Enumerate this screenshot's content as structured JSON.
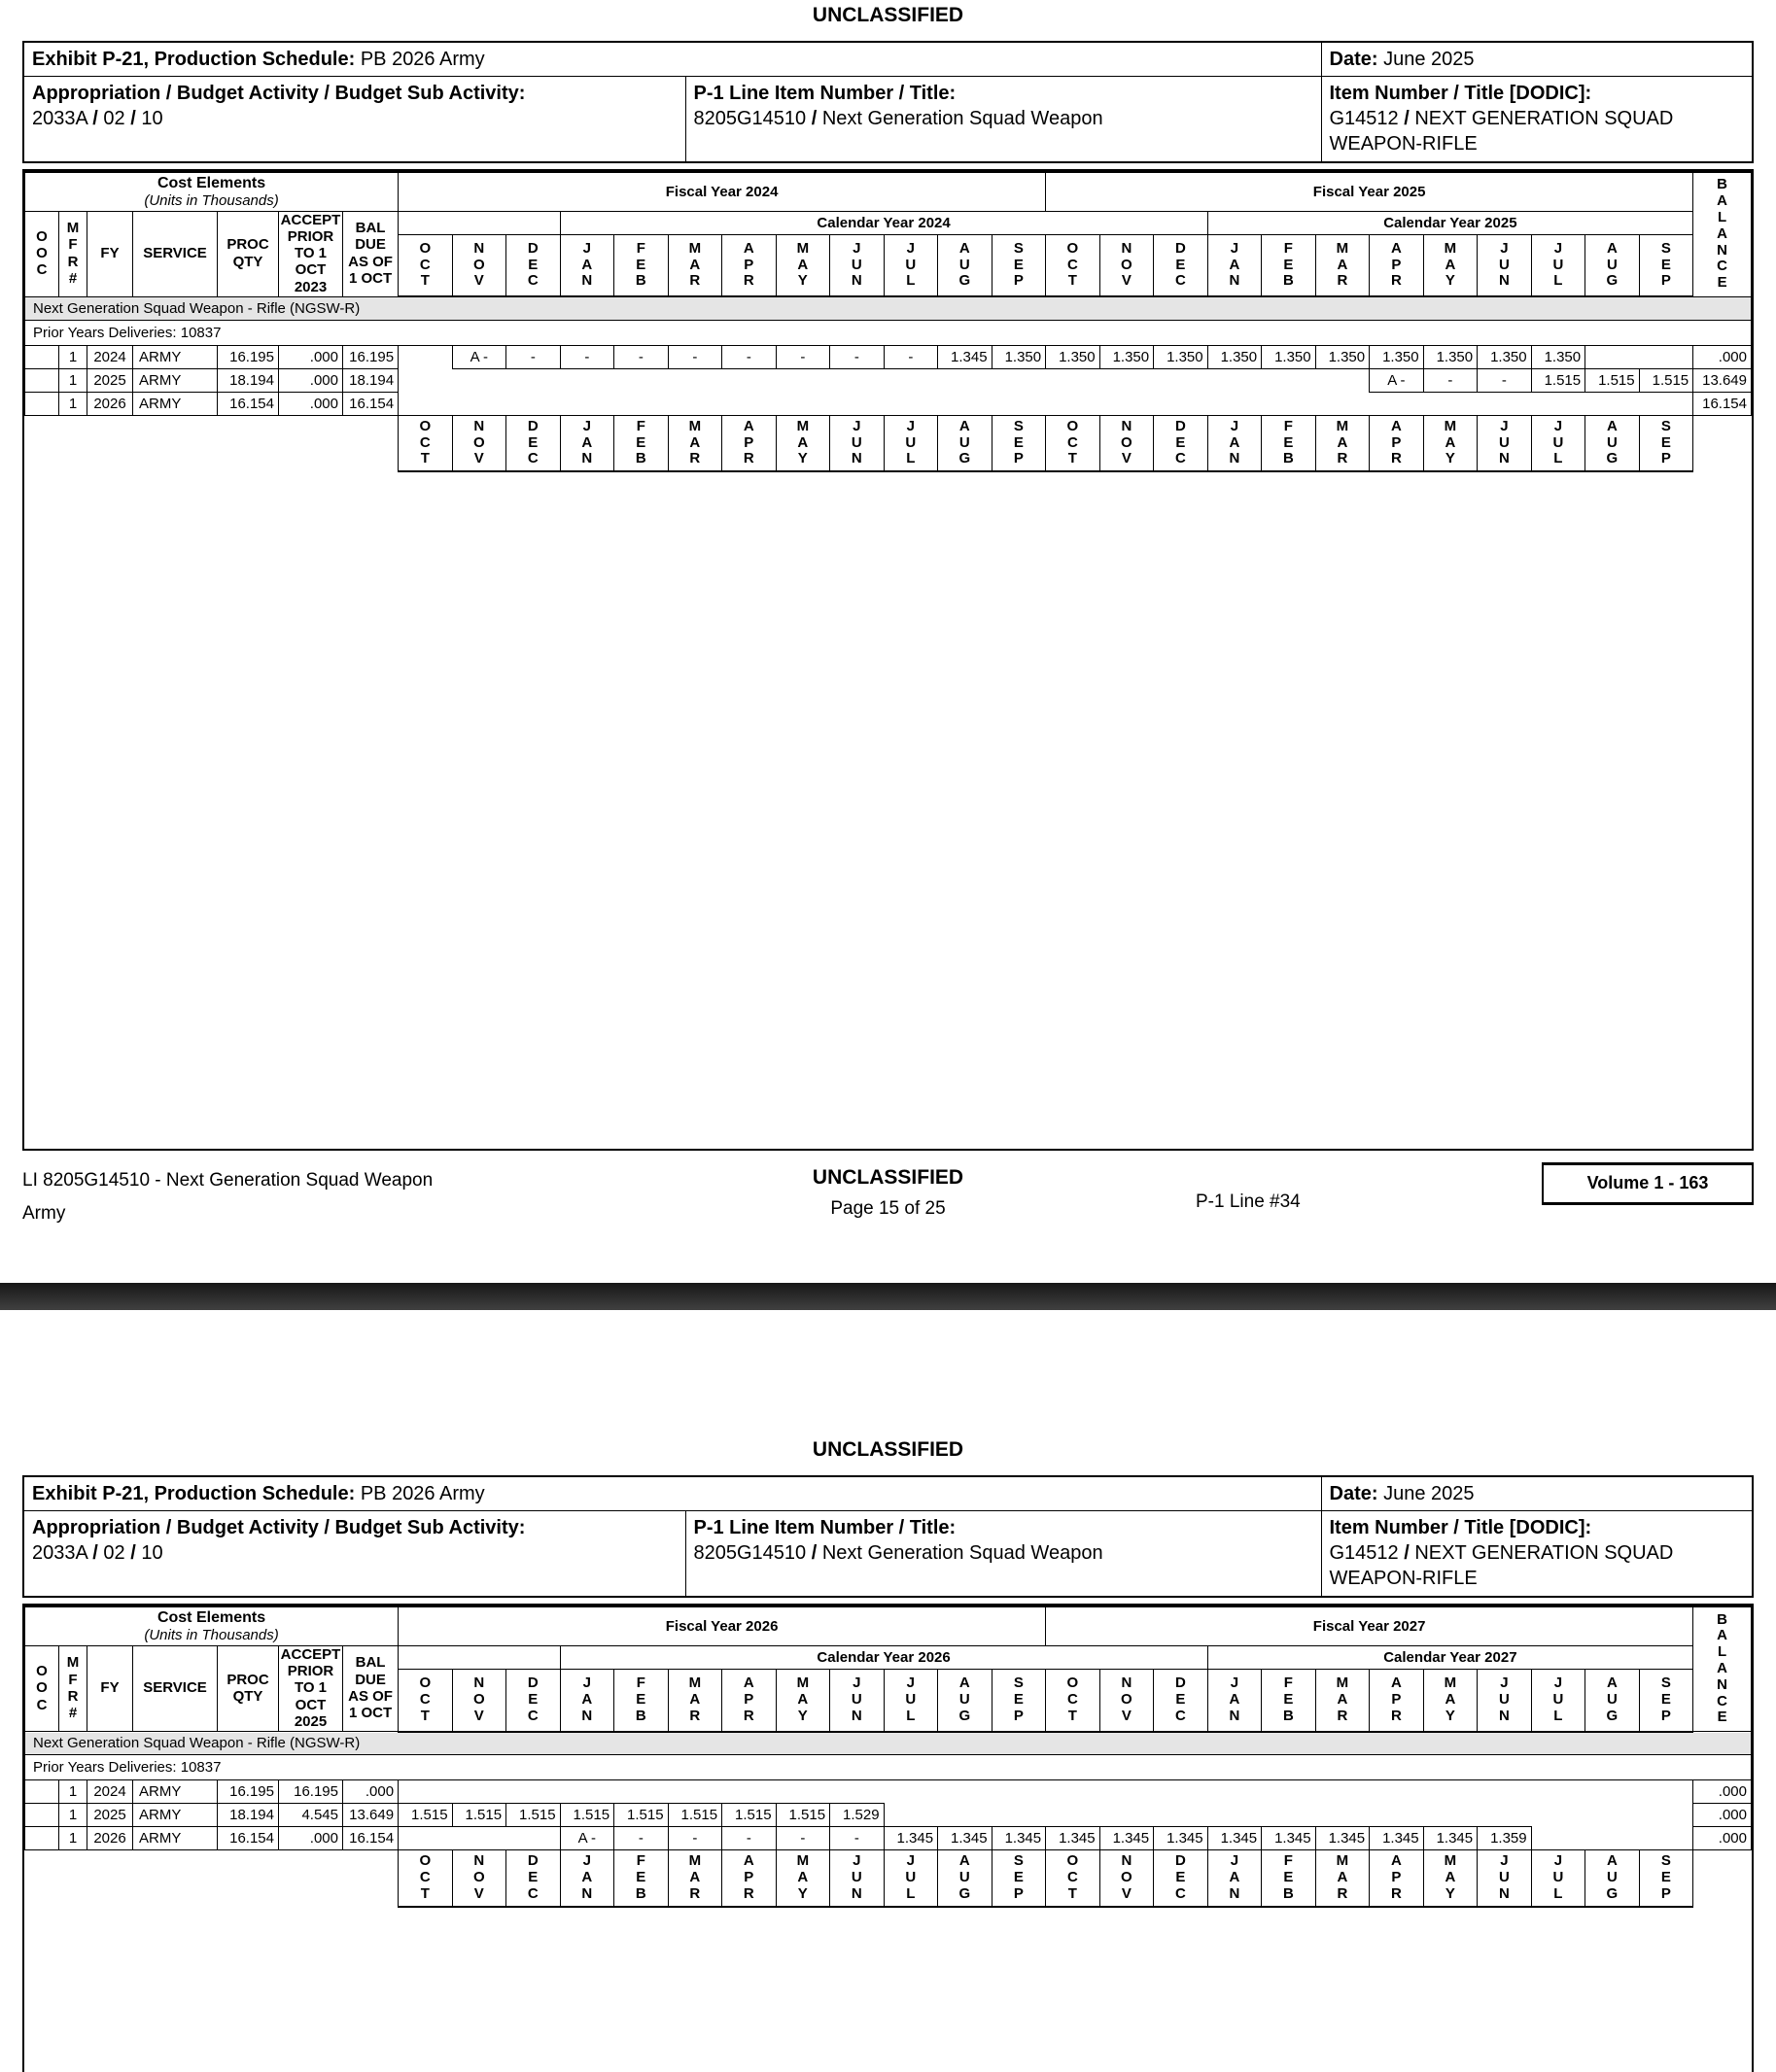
{
  "classification": "UNCLASSIFIED",
  "colors": {
    "band_gray": "#e5e5e5",
    "divider_dark": "#2b2b2b",
    "border": "#000000"
  },
  "pages": [
    {
      "header": {
        "exhibit_label": "Exhibit P-21, Production Schedule:",
        "exhibit_value": "PB 2026 Army",
        "date_label": "Date:",
        "date_value": "June 2025",
        "appropriation_label": "Appropriation / Budget Activity / Budget Sub Activity:",
        "appropriation_value": "2033A / 02 / 10",
        "p1_line_label": "P-1 Line Item Number / Title:",
        "p1_line_value": "8205G14510 / Next Generation Squad Weapon",
        "item_label": "Item Number / Title [DODIC]:",
        "item_value": "G14512 / NEXT GENERATION SQUAD WEAPON-RIFLE"
      },
      "table": {
        "cost_elements_title": "Cost Elements",
        "cost_elements_sub": "(Units in Thousands)",
        "fiscal_years": [
          "Fiscal Year 2024",
          "Fiscal Year 2025"
        ],
        "calendar_years": [
          "Calendar Year 2024",
          "Calendar Year 2025"
        ],
        "left_headers": [
          "O\nO\nC",
          "M\nF\nR\n#",
          "FY",
          "SERVICE",
          "PROC\nQTY",
          "ACCEPT\nPRIOR\nTO 1\nOCT\n2023",
          "BAL\nDUE\nAS OF\n1 OCT"
        ],
        "balance_header": "BALANCE",
        "months": [
          "OCT",
          "NOV",
          "DEC",
          "JAN",
          "FEB",
          "MAR",
          "APR",
          "MAY",
          "JUN",
          "JUL",
          "AUG",
          "SEP"
        ],
        "group_band": "Next Generation Squad Weapon - Rifle (NGSW-R)",
        "prior_years": "Prior Years Deliveries: 10837",
        "rows": [
          {
            "mfr": "1",
            "fy": "2024",
            "service": "ARMY",
            "proc_qty": "16.195",
            "accept": ".000",
            "bal_due": "16.195",
            "months": [
              "",
              "A -",
              "-",
              "-",
              "-",
              "-",
              "-",
              "-",
              "-",
              "-",
              "1.345",
              "1.350",
              "1.350",
              "1.350",
              "1.350",
              "1.350",
              "1.350",
              "1.350",
              "1.350",
              "1.350",
              "1.350",
              "1.350",
              "",
              ""
            ],
            "balance": ".000"
          },
          {
            "mfr": "1",
            "fy": "2025",
            "service": "ARMY",
            "proc_qty": "18.194",
            "accept": ".000",
            "bal_due": "18.194",
            "months": [
              "",
              "",
              "",
              "",
              "",
              "",
              "",
              "",
              "",
              "",
              "",
              "",
              "",
              "",
              "",
              "",
              "",
              "",
              "A -",
              "-",
              "-",
              "1.515",
              "1.515",
              "1.515"
            ],
            "balance": "13.649"
          },
          {
            "mfr": "1",
            "fy": "2026",
            "service": "ARMY",
            "proc_qty": "16.154",
            "accept": ".000",
            "bal_due": "16.154",
            "months": [
              "",
              "",
              "",
              "",
              "",
              "",
              "",
              "",
              "",
              "",
              "",
              "",
              "",
              "",
              "",
              "",
              "",
              "",
              "",
              "",
              "",
              "",
              "",
              ""
            ],
            "balance": "16.154"
          }
        ]
      },
      "footer": {
        "line1": "LI 8205G14510 - Next Generation Squad Weapon",
        "line2": "Army",
        "page": "Page 15 of 25",
        "p1_line": "P-1 Line #34",
        "volume": "Volume 1 - 163"
      }
    },
    {
      "header": {
        "exhibit_label": "Exhibit P-21, Production Schedule:",
        "exhibit_value": "PB 2026 Army",
        "date_label": "Date:",
        "date_value": "June 2025",
        "appropriation_label": "Appropriation / Budget Activity / Budget Sub Activity:",
        "appropriation_value": "2033A / 02 / 10",
        "p1_line_label": "P-1 Line Item Number / Title:",
        "p1_line_value": "8205G14510 / Next Generation Squad Weapon",
        "item_label": "Item Number / Title [DODIC]:",
        "item_value": "G14512 / NEXT GENERATION SQUAD WEAPON-RIFLE"
      },
      "table": {
        "cost_elements_title": "Cost Elements",
        "cost_elements_sub": "(Units in Thousands)",
        "fiscal_years": [
          "Fiscal Year 2026",
          "Fiscal Year 2027"
        ],
        "calendar_years": [
          "Calendar Year 2026",
          "Calendar Year 2027"
        ],
        "left_headers": [
          "O\nO\nC",
          "M\nF\nR\n#",
          "FY",
          "SERVICE",
          "PROC\nQTY",
          "ACCEPT\nPRIOR\nTO 1\nOCT\n2025",
          "BAL\nDUE\nAS OF\n1 OCT"
        ],
        "balance_header": "BALANCE",
        "months": [
          "OCT",
          "NOV",
          "DEC",
          "JAN",
          "FEB",
          "MAR",
          "APR",
          "MAY",
          "JUN",
          "JUL",
          "AUG",
          "SEP"
        ],
        "group_band": "Next Generation Squad Weapon - Rifle (NGSW-R)",
        "prior_years": "Prior Years Deliveries: 10837",
        "rows": [
          {
            "mfr": "1",
            "fy": "2024",
            "service": "ARMY",
            "proc_qty": "16.195",
            "accept": "16.195",
            "bal_due": ".000",
            "months": [
              "",
              "",
              "",
              "",
              "",
              "",
              "",
              "",
              "",
              "",
              "",
              "",
              "",
              "",
              "",
              "",
              "",
              "",
              "",
              "",
              "",
              "",
              "",
              ""
            ],
            "balance": ".000"
          },
          {
            "mfr": "1",
            "fy": "2025",
            "service": "ARMY",
            "proc_qty": "18.194",
            "accept": "4.545",
            "bal_due": "13.649",
            "months": [
              "1.515",
              "1.515",
              "1.515",
              "1.515",
              "1.515",
              "1.515",
              "1.515",
              "1.515",
              "1.529",
              "",
              "",
              "",
              "",
              "",
              "",
              "",
              "",
              "",
              "",
              "",
              "",
              "",
              "",
              ""
            ],
            "balance": ".000"
          },
          {
            "mfr": "1",
            "fy": "2026",
            "service": "ARMY",
            "proc_qty": "16.154",
            "accept": ".000",
            "bal_due": "16.154",
            "months": [
              "",
              "",
              "",
              "A -",
              "-",
              "-",
              "-",
              "-",
              "-",
              "1.345",
              "1.345",
              "1.345",
              "1.345",
              "1.345",
              "1.345",
              "1.345",
              "1.345",
              "1.345",
              "1.345",
              "1.345",
              "1.359",
              "",
              "",
              ""
            ],
            "balance": ".000"
          }
        ]
      }
    }
  ]
}
